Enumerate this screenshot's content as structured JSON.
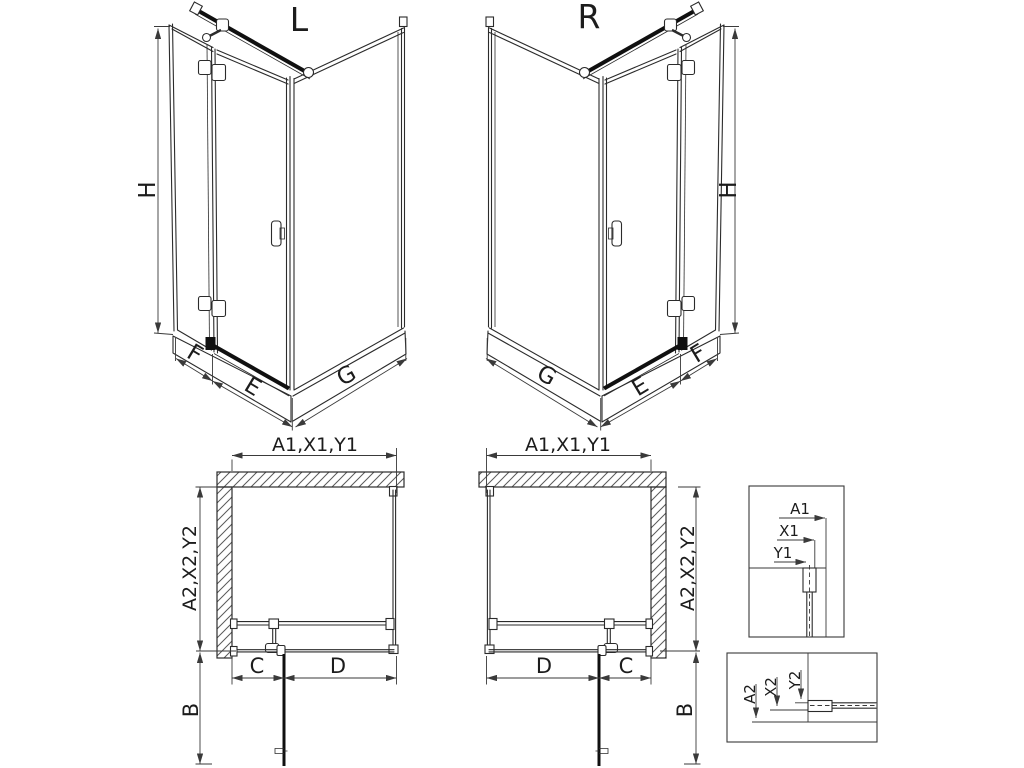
{
  "drawing": {
    "background": "#ffffff",
    "line_color": "#2b2b2b",
    "thick_line_color": "#101010",
    "iso_left": {
      "title": "L",
      "height_dim": "H",
      "fixed_panel_dim": "F",
      "door_dim": "E",
      "side_panel_dim": "G"
    },
    "iso_right": {
      "title": "R",
      "height_dim": "H",
      "fixed_panel_dim": "F",
      "door_dim": "E",
      "side_panel_dim": "G"
    },
    "plan_left": {
      "width_dim": "A1,X1,Y1",
      "depth_dim": "A2,X2,Y2",
      "fixed_segment_dim": "C",
      "door_segment_dim": "D",
      "door_swing_dim": "B"
    },
    "plan_right": {
      "width_dim": "A1,X1,Y1",
      "depth_dim": "A2,X2,Y2",
      "fixed_segment_dim": "C",
      "door_segment_dim": "D",
      "door_swing_dim": "B"
    },
    "detail_width_section": {
      "a": "A1",
      "x": "X1",
      "y": "Y1"
    },
    "detail_depth_section": {
      "a": "A2",
      "x": "X2",
      "y": "Y2"
    }
  }
}
